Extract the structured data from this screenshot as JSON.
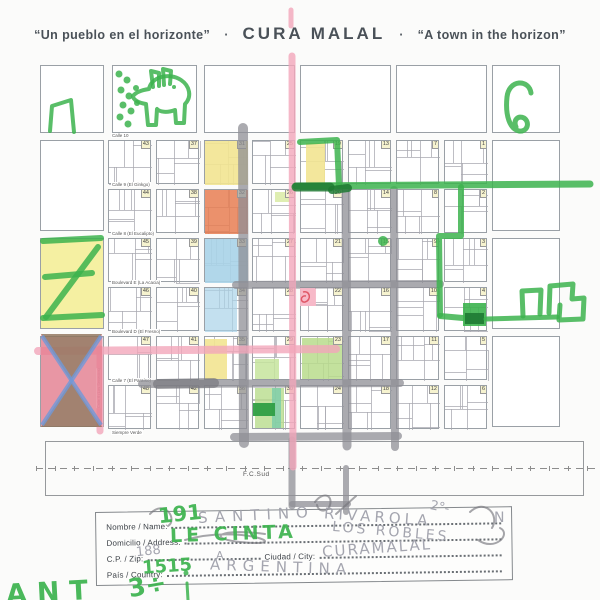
{
  "title": {
    "quote_es": "“Un pueblo en el horizonte”",
    "separator": "·",
    "name": "CURA MALAL",
    "quote_en": "“A town in the horizon”"
  },
  "map": {
    "grid": [
      [
        43,
        37,
        31,
        25,
        19,
        13,
        7,
        1
      ],
      [
        44,
        38,
        32,
        26,
        20,
        14,
        8,
        2
      ],
      [
        45,
        39,
        33,
        27,
        21,
        15,
        9,
        3
      ],
      [
        46,
        40,
        34,
        28,
        22,
        16,
        10,
        4
      ],
      [
        47,
        41,
        35,
        29,
        23,
        17,
        11,
        5
      ],
      [
        48,
        42,
        36,
        30,
        24,
        18,
        12,
        6
      ]
    ],
    "streets_h": [
      "Calle 10",
      "Calle 9 (El Ginkgo)",
      "Calle 8 (El Eucalipto)",
      "Boulevard E (La Acacia)",
      "Boulevard D (El Fresno)",
      "Calle 7 (El Paraíso)",
      "Siempre Verde"
    ],
    "street_v_left": "Calle 6 (Los Senecios)",
    "railway_label": "F.C.Sud",
    "painted": {
      "31": [
        {
          "x": 0,
          "y": 0,
          "w": 1,
          "h": 1,
          "c": "#f2e491",
          "o": 0.9
        }
      ],
      "32": [
        {
          "x": 0,
          "y": 0,
          "w": 1,
          "h": 1,
          "c": "#e87e52",
          "o": 0.85,
          "t": "s"
        }
      ],
      "33": [
        {
          "x": 0,
          "y": 0,
          "w": 1,
          "h": 1,
          "c": "#a9d3e8",
          "o": 0.9
        }
      ],
      "34": [
        {
          "x": 0,
          "y": 0,
          "w": 0.75,
          "h": 1,
          "c": "#a9d3e8",
          "o": 0.7
        }
      ],
      "19": [
        {
          "x": 0.12,
          "y": 0.05,
          "w": 0.45,
          "h": 0.9,
          "c": "#f2e491",
          "o": 0.9
        }
      ],
      "35": [
        {
          "x": 0,
          "y": 0.05,
          "w": 0.5,
          "h": 0.9,
          "c": "#f2e491",
          "o": 0.9
        }
      ],
      "26": [
        {
          "x": 0.5,
          "y": 0.05,
          "w": 0.35,
          "h": 0.22,
          "c": "#dcecaa",
          "o": 0.9
        }
      ],
      "23": [
        {
          "x": 0.03,
          "y": 0.03,
          "w": 0.94,
          "h": 0.94,
          "c": "#b8dc8c",
          "o": 0.85
        }
      ],
      "29": [
        {
          "x": 0.05,
          "y": 0.5,
          "w": 0.55,
          "h": 0.45,
          "c": "#c6e49c",
          "o": 0.85
        }
      ],
      "30": [
        {
          "x": 0.05,
          "y": 0.05,
          "w": 0.68,
          "h": 0.9,
          "c": "#b8dc8c",
          "o": 0.8
        },
        {
          "x": 0.45,
          "y": 0.05,
          "w": 0.2,
          "h": 0.9,
          "c": "#7accaa",
          "o": 0.8
        },
        {
          "x": 0,
          "y": 0.38,
          "w": 0.5,
          "h": 0.3,
          "c": "#2f9e44",
          "o": 0.95
        }
      ],
      "22": [
        {
          "x": 0,
          "y": 0,
          "w": 0.35,
          "h": 0.42,
          "c": "#f6b8c8",
          "o": 0.9
        }
      ]
    }
  },
  "form": {
    "labels": {
      "name": "Nombre / Name:",
      "address": "Domicilio / Address:",
      "zip": "C.P. / Zip:",
      "city": "Ciudad / City:",
      "country": "País / Country:"
    },
    "entries": {
      "name_green": "191",
      "name_pencil_1": "SANTINO",
      "name_pencil_2": "RIVAROLA",
      "name_pencil_3": "2°-",
      "name_pencil_4": "N",
      "address_green": "LE CINTA",
      "address_pencil": "LOS ROBLES",
      "zip_pencil": "188",
      "zip_stray": "A",
      "city_pencil": "CURAMALAL",
      "country_green": "1515",
      "country_pencil": "ARGENTINA"
    }
  },
  "page_scribbles": {
    "fragment_1": "ANT",
    "fragment_2": "3÷"
  },
  "colors": {
    "marker_green": "#3cb34e",
    "marker_green_dark": "#1e7a33",
    "marker_pink": "#f2a6ba",
    "pink_fill": "#f6b8c8",
    "pencil": "#8f8f96",
    "crayon_yellow": "#f2e491",
    "crayon_blue": "#a9d3e8",
    "crayon_orange": "#e87e52",
    "crayon_lightgreen": "#b8dc8c",
    "crayon_darkgreen": "#2f9e44",
    "crayon_teal": "#7accaa",
    "crayon_red": "#e06b7e",
    "crayon_brown": "#8d7158",
    "crayon_blueline": "#6f99d8",
    "number_bg": "#f6f3cf"
  }
}
